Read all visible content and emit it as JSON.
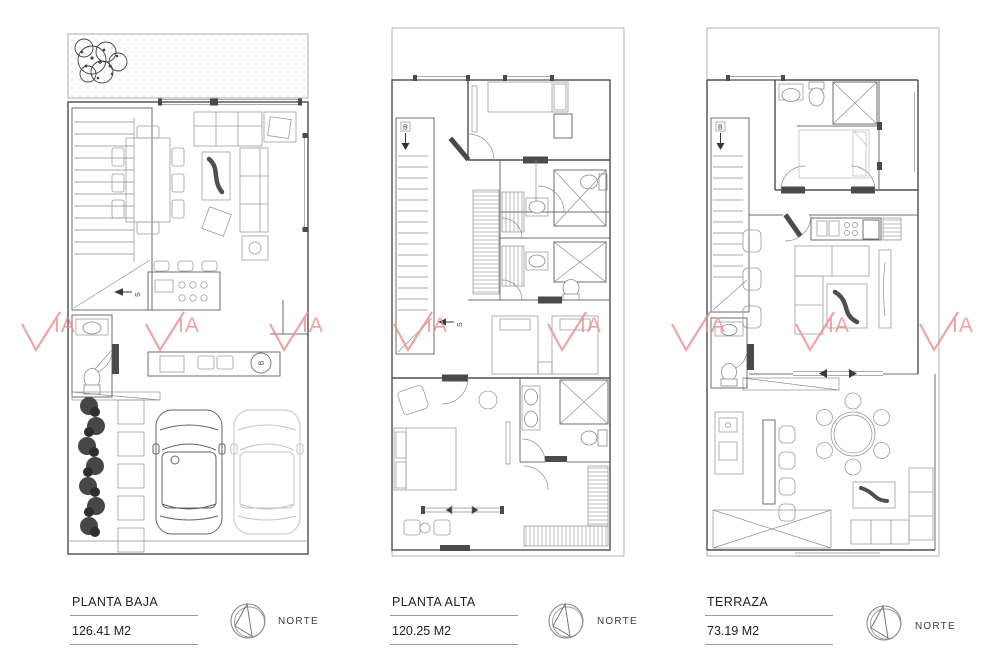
{
  "watermark": {
    "brand": "VIA",
    "check_suffix": "IA",
    "color": "#ee8d8d"
  },
  "plans": [
    {
      "title": "PLANTA BAJA",
      "area": "126.41 M2",
      "north_label": "NORTE",
      "stair_up_label": "S",
      "boiler_label": "B"
    },
    {
      "title": "PLANTA ALTA",
      "area": "120.25 M2",
      "north_label": "NORTE",
      "stair_up_label": "S",
      "stair_down_label": "B"
    },
    {
      "title": "TERRAZA",
      "area": "73.19 M2",
      "north_label": "NORTE",
      "stair_down_label": "B"
    }
  ]
}
